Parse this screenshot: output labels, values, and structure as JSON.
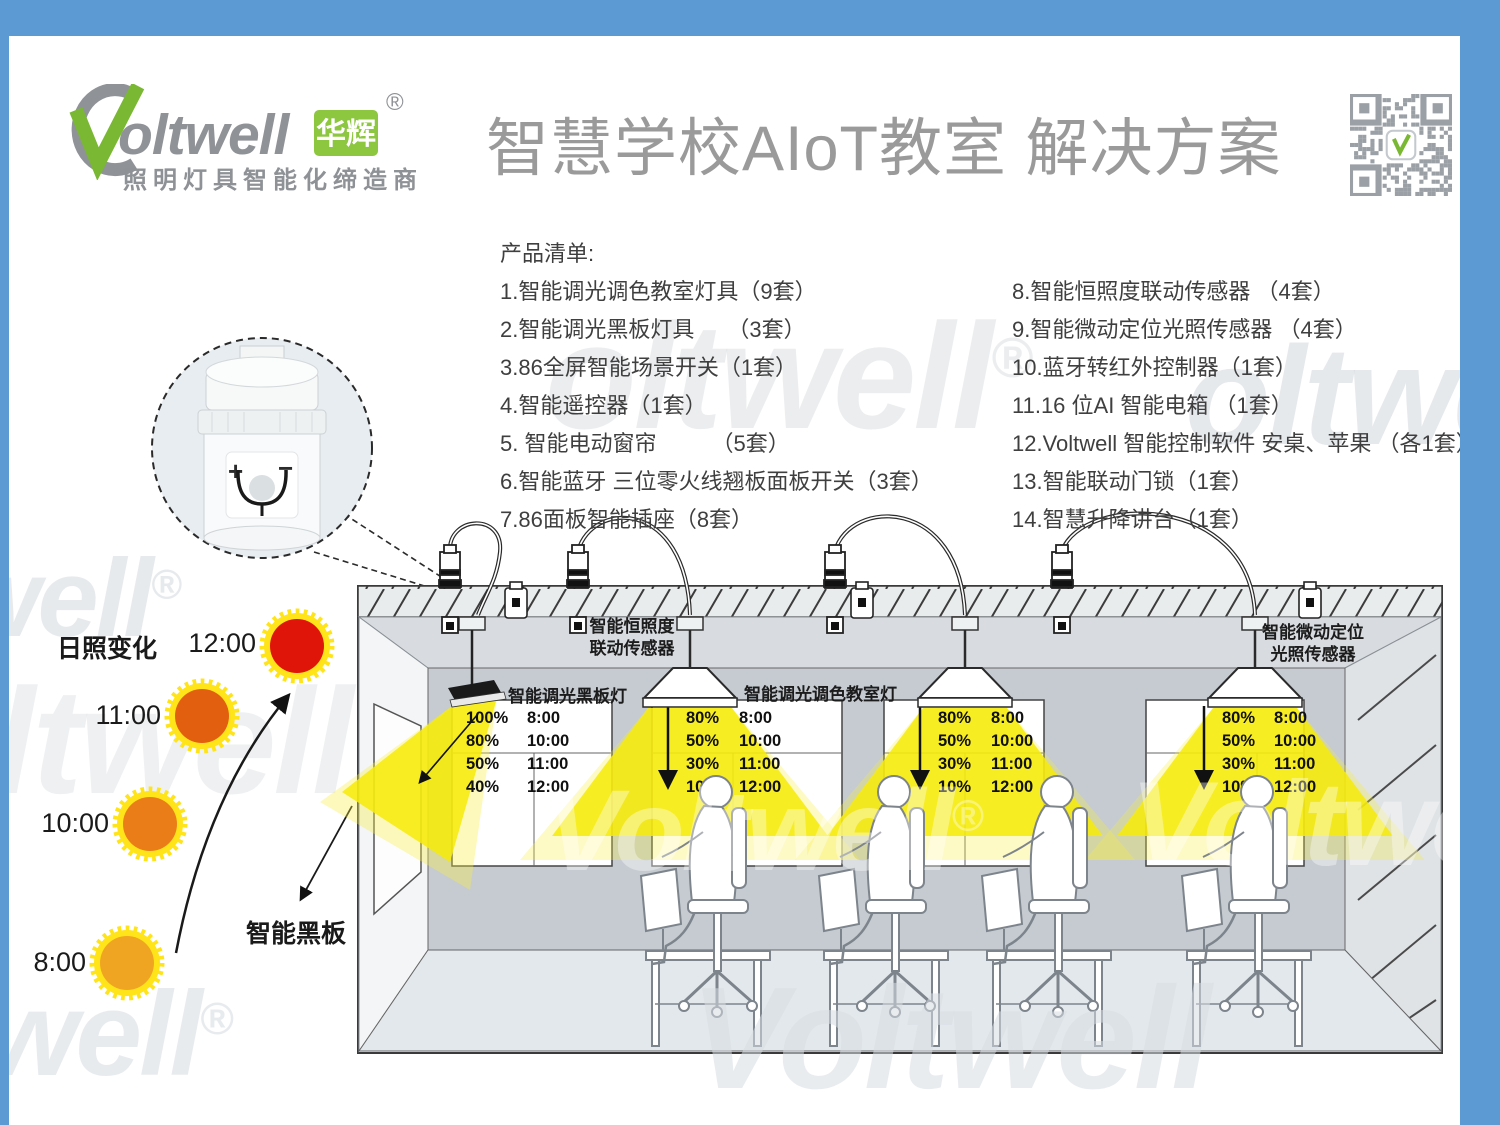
{
  "frame": {
    "color": "#5b9ad3"
  },
  "brand": {
    "name": "oltwell",
    "name_cn": "华辉",
    "registered": "®",
    "tagline": "照明灯具智能化缔造商"
  },
  "title": "智慧学校AIoT教室 解决方案",
  "watermark": {
    "full": "Voltwell",
    "p_oltwell": "oltwell",
    "p_oltwe": "oltwe",
    "p_well": "well",
    "p_voltwe": "Voltwe",
    "reg": "®"
  },
  "product_list": {
    "heading": "产品清单:",
    "left": [
      "1.智能调光调色教室灯具（9套）",
      "2.智能调光黑板灯具　　（3套）",
      "3.86全屏智能场景开关（1套）",
      "4.智能遥控器（1套）",
      "5. 智能电动窗帘　　　（5套）",
      "6.智能蓝牙 三位零火线翘板面板开关（3套）",
      "7.86面板智能插座（8套）"
    ],
    "right": [
      "8.智能恒照度联动传感器 （4套）",
      "9.智能微动定位光照传感器 （4套）",
      "10.蓝牙转红外控制器（1套）",
      "11.16 位AI 智能电箱 （1套）",
      "12.Voltwell 智能控制软件 安桌、苹果 （各1套）",
      "13.智能联动门锁（1套）",
      "14.智慧升降讲台（1套）"
    ]
  },
  "sunlight": {
    "label": "日照变化",
    "blackboard_label": "智能黑板",
    "suns": [
      {
        "time": "12:00",
        "color": "#e0150a"
      },
      {
        "time": "11:00",
        "color": "#e35f10"
      },
      {
        "time": "10:00",
        "color": "#ea7d17"
      },
      {
        "time": "8:00",
        "color": "#f0a522"
      }
    ]
  },
  "diagram": {
    "sensor1_line1": "智能恒照度",
    "sensor1_line2": "联动传感器",
    "sensor2_line1": "智能微动定位",
    "sensor2_line2": "光照传感器",
    "blackboard_light": "智能调光黑板灯",
    "classroom_light": "智能调光调色教室灯",
    "sensor_plus": "+",
    "sensor_minus": "−",
    "blackboard_schedule": [
      {
        "pct": "100%",
        "time": "8:00"
      },
      {
        "pct": "80%",
        "time": "10:00"
      },
      {
        "pct": "50%",
        "time": "11:00"
      },
      {
        "pct": "40%",
        "time": "12:00"
      }
    ],
    "classroom_schedule": [
      {
        "pct": "80%",
        "time": "8:00"
      },
      {
        "pct": "50%",
        "time": "10:00"
      },
      {
        "pct": "30%",
        "time": "11:00"
      },
      {
        "pct": "10%",
        "time": "12:00"
      }
    ]
  }
}
